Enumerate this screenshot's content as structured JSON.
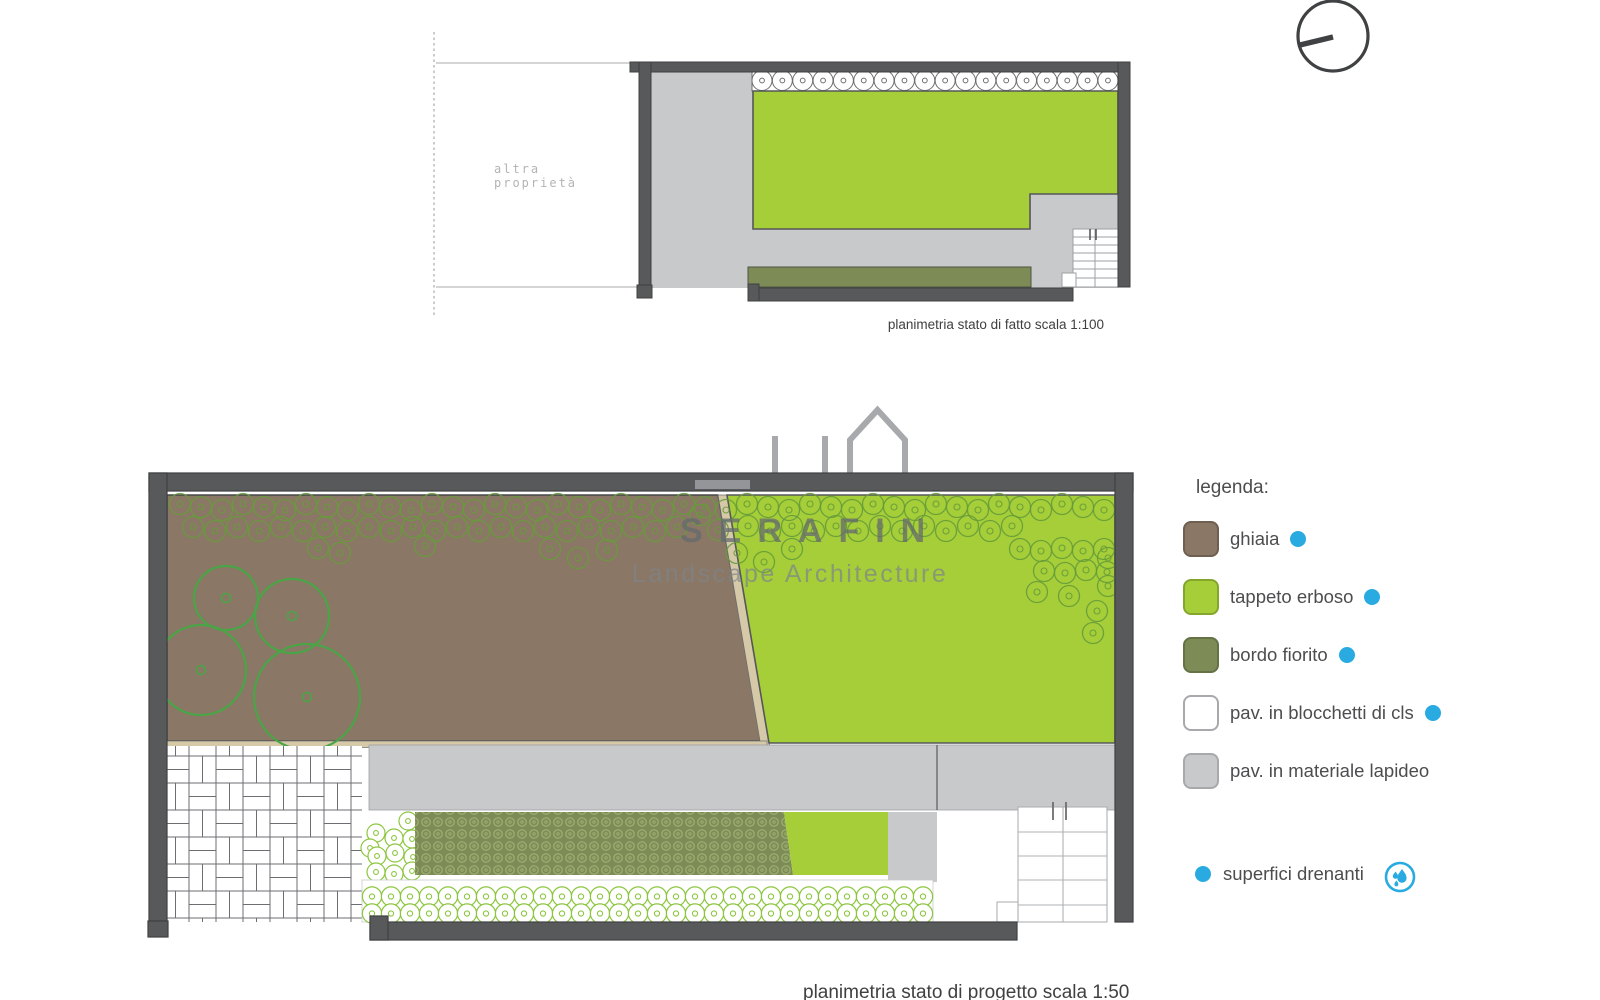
{
  "watermark": {
    "name": "SERAFIN",
    "subtitle": "Landscape Architecture"
  },
  "plans": {
    "existing": {
      "caption": "planimetria stato di fatto scala 1:100",
      "neighbor_label": "altra\nproprietà"
    },
    "project": {
      "caption": "planimetria stato di progetto scala 1:50"
    }
  },
  "legend": {
    "title": "legenda:",
    "items": [
      {
        "label": "ghiaia",
        "color": "#8a7765",
        "drainable": true
      },
      {
        "label": "tappeto erboso",
        "color": "#a6ce39",
        "drainable": true
      },
      {
        "label": "bordo fiorito",
        "color": "#7d8b57",
        "drainable": true
      },
      {
        "label": "pav. in blocchetti di cls",
        "color": "#ffffff",
        "drainable": true
      },
      {
        "label": "pav. in materiale lapideo",
        "color": "#c8c9cb",
        "drainable": false
      }
    ],
    "drainage_note": {
      "label": "superfici drenanti",
      "color": "#29abe2",
      "icon": "water-drops-icon"
    }
  },
  "colors": {
    "wall": "#58595b",
    "paving_stone": "#c8c9cb",
    "gravel": "#8a7765",
    "lawn": "#a6ce39",
    "flower_border": "#7d8b57",
    "edging_tan": "#d5c9a7",
    "accent_blue": "#29abe2",
    "tree_stroke": "#4aa546"
  }
}
